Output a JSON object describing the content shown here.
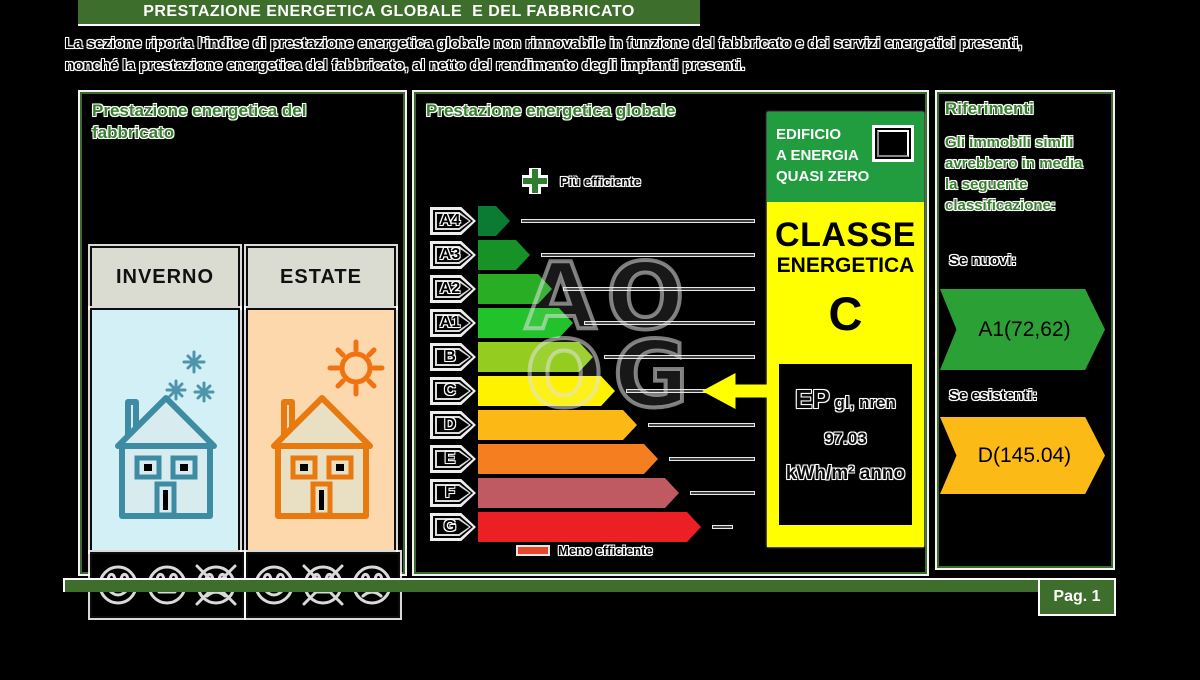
{
  "header": {
    "title": "PRESTAZIONE ENERGETICA GLOBALE  E DEL FABBRICATO",
    "description_lines": [
      "La sezione riporta l'indice di prestazione energetica globale non rinnovabile in funzione del fabbricato e dei servizi energetici presenti,",
      "nonché la prestazione energetica del fabbricato, al netto del rendimento degli impianti presenti."
    ]
  },
  "fabbricato_panel": {
    "title_lines": [
      "Prestazione energetica del",
      "fabbricato"
    ],
    "columns": [
      {
        "label": "INVERNO",
        "season": "winter",
        "faces": [
          {
            "mood": "happy",
            "crossed": false
          },
          {
            "mood": "neutral",
            "crossed": false
          },
          {
            "mood": "sad",
            "crossed": true
          }
        ]
      },
      {
        "label": "ESTATE",
        "season": "summer",
        "faces": [
          {
            "mood": "happy",
            "crossed": false
          },
          {
            "mood": "neutral",
            "crossed": true
          },
          {
            "mood": "sad",
            "crossed": false
          }
        ]
      }
    ]
  },
  "globale_panel": {
    "title": "Prestazione energetica globale",
    "more_efficient_label": "Più efficiente",
    "less_efficient_label": "Meno efficiente",
    "classes": [
      {
        "label": "A4",
        "color": "#0b7a32",
        "arrow_width": 32
      },
      {
        "label": "A3",
        "color": "#169226",
        "arrow_width": 52
      },
      {
        "label": "A2",
        "color": "#29ad24",
        "arrow_width": 74
      },
      {
        "label": "A1",
        "color": "#22c32a",
        "arrow_width": 95
      },
      {
        "label": "B",
        "color": "#94cd1f",
        "arrow_width": 115
      },
      {
        "label": "C",
        "color": "#fef200",
        "arrow_width": 137
      },
      {
        "label": "D",
        "color": "#fcb814",
        "arrow_width": 159
      },
      {
        "label": "E",
        "color": "#f57e20",
        "arrow_width": 180
      },
      {
        "label": "F",
        "color": "#c05a62",
        "arrow_width": 201
      },
      {
        "label": "G",
        "color": "#ec2024",
        "arrow_width": 223
      }
    ],
    "selected_class": "C"
  },
  "class_box": {
    "nzeb_lines": [
      "EDIFICIO",
      "A ENERGIA",
      "QUASI ZERO"
    ],
    "nzeb_checked": false,
    "classe_word": "CLASSE",
    "energetica_word": "ENERGETICA",
    "class_letter": "C",
    "ep_label_main": "EP",
    "ep_label_sub": " gl, nren",
    "ep_value": "97.03",
    "ep_unit": "kWh/m² anno",
    "header_color": "#219c3e",
    "box_color": "#ffff00"
  },
  "riferimenti_panel": {
    "title": "Riferimenti",
    "text_lines": [
      "Gli immobili simili",
      "avrebbero in media",
      "la seguente",
      "classificazione:"
    ],
    "new_label": "Se nuovi:",
    "new_value": "A1(72,62)",
    "new_color": "#2ba135",
    "existing_label": "Se esistenti:",
    "existing_value": "D(145.04)",
    "existing_color": "#fcba17"
  },
  "watermark_lines": [
    "AO",
    "OG"
  ],
  "footer": {
    "page_label": "Pag. 1"
  }
}
